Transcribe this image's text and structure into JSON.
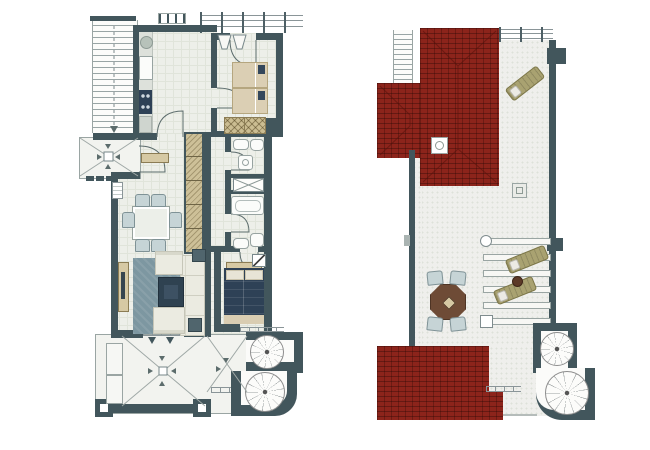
{
  "document": {
    "type": "floor-plan-drawing",
    "background": "#ffffff",
    "pages": 2
  },
  "palette": {
    "wall": "#42565c",
    "floor": "#edefe9",
    "floor_line": "#e0e4da",
    "porch_floor": "#f2f3ef",
    "terrace_floor": "#efefec",
    "speckle": "#dde1d9",
    "roof": "#8c241b",
    "rail": "#4e6066",
    "rail_line": "#8a9598",
    "outline": "#9aa5a3",
    "stair_line": "#99a5a5",
    "tan": "#d6c9a4",
    "tan_dark": "#8b7c54",
    "navy": "#2e4156",
    "rug": "#7d97a1",
    "sofa": "#ebebe1",
    "chair": "#c6d4d6",
    "wood": "#6e4b36",
    "olive": "#a9a271",
    "fixture": "#fbfcfa"
  },
  "plans": {
    "main_floor": {
      "id": "main-floor-plan",
      "rooms": [
        "kitchen",
        "twin-bedroom",
        "hallway",
        "corridor",
        "bathroom-shower",
        "closet",
        "bathroom-tub",
        "dining-area",
        "living-room",
        "master-bedroom",
        "entrance-porch",
        "terrace",
        "balcony"
      ],
      "circulation": [
        "external-staircase",
        "spiral-staircase",
        "doors"
      ],
      "furniture": [
        "kitchen-counter",
        "sink",
        "stove",
        "fridge",
        "twin-beds",
        "wardrobe",
        "tall-hall-wardrobe",
        "dining-table",
        "six-dining-chairs",
        "sideboard",
        "rug",
        "sofa",
        "two-armchairs",
        "coffee-table",
        "side-tables",
        "double-bed",
        "bathtub",
        "shower",
        "toilets",
        "washbasins",
        "radiator",
        "shelf"
      ]
    },
    "roof_terrace": {
      "id": "roof-terrace-plan",
      "features": [
        "upper-tiled-roof",
        "roof-wing",
        "lower-tiled-roof",
        "roof-ladder",
        "roof-skylight",
        "terrace-skylight",
        "perimeter-railing",
        "parapet-walls",
        "pergola",
        "spiral-staircase"
      ],
      "furniture": [
        "sun-lounger",
        "two-pergola-loungers",
        "round-side-table",
        "octagonal-table",
        "four-chairs"
      ]
    }
  }
}
